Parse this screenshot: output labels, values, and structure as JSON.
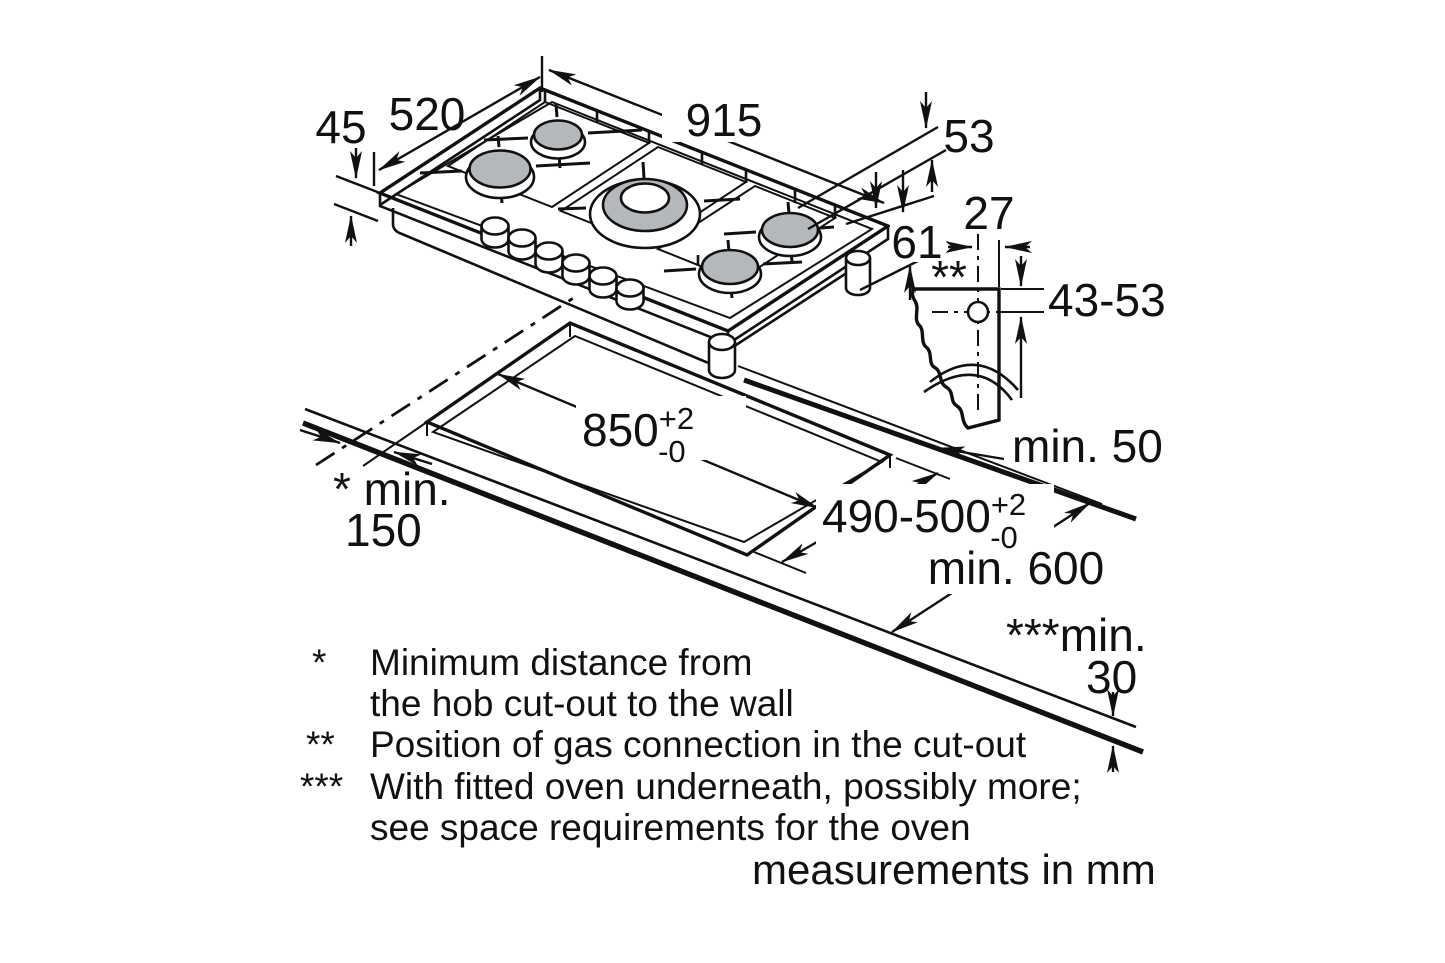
{
  "dimensions": {
    "hob_profile_height": "45",
    "hob_depth": "520",
    "hob_width": "915",
    "hob_rear_edge_offset": "53",
    "hob_underside_offset": "61",
    "gas_connection_inset": "27",
    "gas_connection_marker": "**",
    "gas_connection_depth": "43-53",
    "cutout_to_rear_edge": "min. 50",
    "cutout_width": {
      "value": "850",
      "tolerance_plus": "+2",
      "tolerance_minus": "-0"
    },
    "cutout_depth": {
      "value": "490-500",
      "tolerance_plus": "+2",
      "tolerance_minus": "-0"
    },
    "wall_clearance": {
      "prefix": "* min.",
      "value": "150"
    },
    "worktop_depth": "min. 600",
    "oven_clearance": {
      "prefix": "***min.",
      "value": "30"
    }
  },
  "footnotes": {
    "f1": {
      "marker": "*",
      "line1": "Minimum distance from",
      "line2": "the hob cut-out to the wall"
    },
    "f2": {
      "marker": "**",
      "line1": "Position of gas connection in the cut-out"
    },
    "f3": {
      "marker": "***",
      "line1": "With fitted oven underneath, possibly more;",
      "line2": "see space requirements for the oven"
    }
  },
  "caption": "measurements in mm"
}
